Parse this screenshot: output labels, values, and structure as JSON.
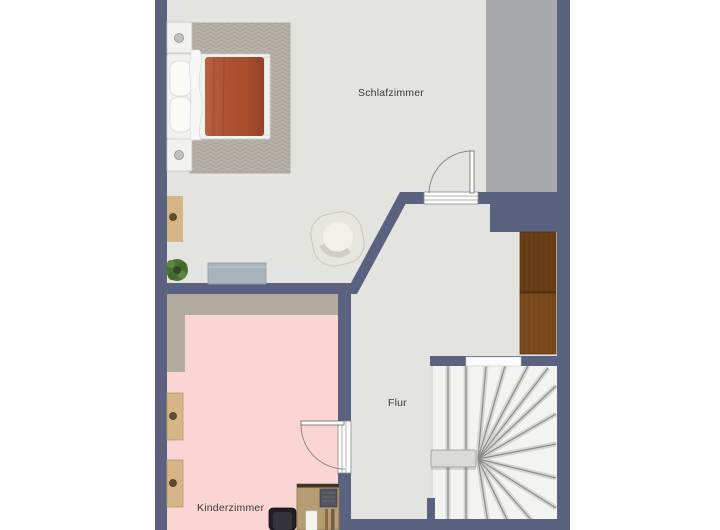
{
  "plan": {
    "type": "floorplan-top-view",
    "rooms": {
      "schlafzimmer": {
        "label": "Schlafzimmer"
      },
      "flur": {
        "label": "Flur"
      },
      "kinderzimmer": {
        "label": "Kinderzimmer"
      }
    },
    "colors": {
      "background": "#ffffff",
      "wall": "#5a6280",
      "floor_light": "#e3e3df",
      "floor_low_ceiling": "#a7a9ac",
      "kinder_floor": "#fbd5d3",
      "kinder_low_ceiling": "#b2ab9e",
      "rug": "#b7b2a9",
      "duvet": "#b0512f",
      "white_furniture": "#f1f1ef",
      "wood_light": "#d5b586",
      "wood_desk": "#b59d71",
      "wardrobe_upper": "#6b3f17",
      "wardrobe_lower": "#7c4c1e",
      "sideboard": "#a9b3ba",
      "plant": "#4c7233",
      "stair_floor": "#f3f3f1",
      "chair_dark": "#202024",
      "armchair": "#e7e5df",
      "door_frame": "#fdfdfd"
    }
  }
}
